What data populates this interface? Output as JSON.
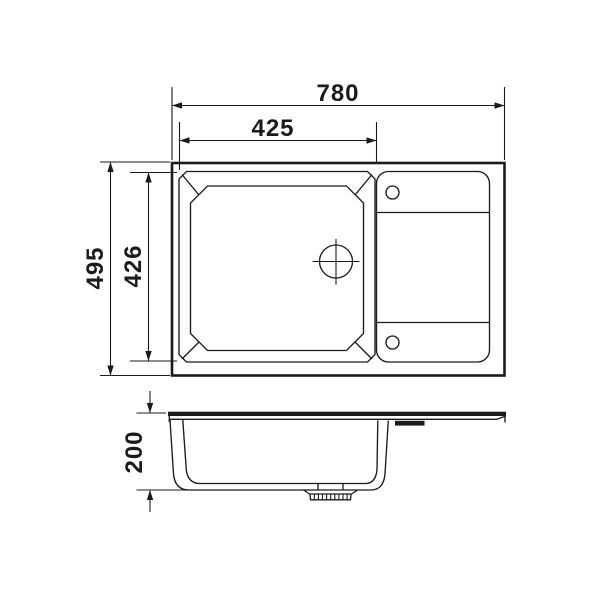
{
  "drawing": {
    "kind": "kitchen-sink technical drawing, top view and front section view",
    "views": {
      "top_view": "plan view of sink with bowl, drainboard and drain",
      "side_view": "front section with bowl depth and drain fitting"
    }
  },
  "dimensions": {
    "overall_width": "780",
    "bowl_width": "425",
    "overall_depth": "495",
    "bowl_depth": "426",
    "bowl_height": "200"
  },
  "colors": {
    "line": "#1b1b1b",
    "background": "#ffffff"
  }
}
